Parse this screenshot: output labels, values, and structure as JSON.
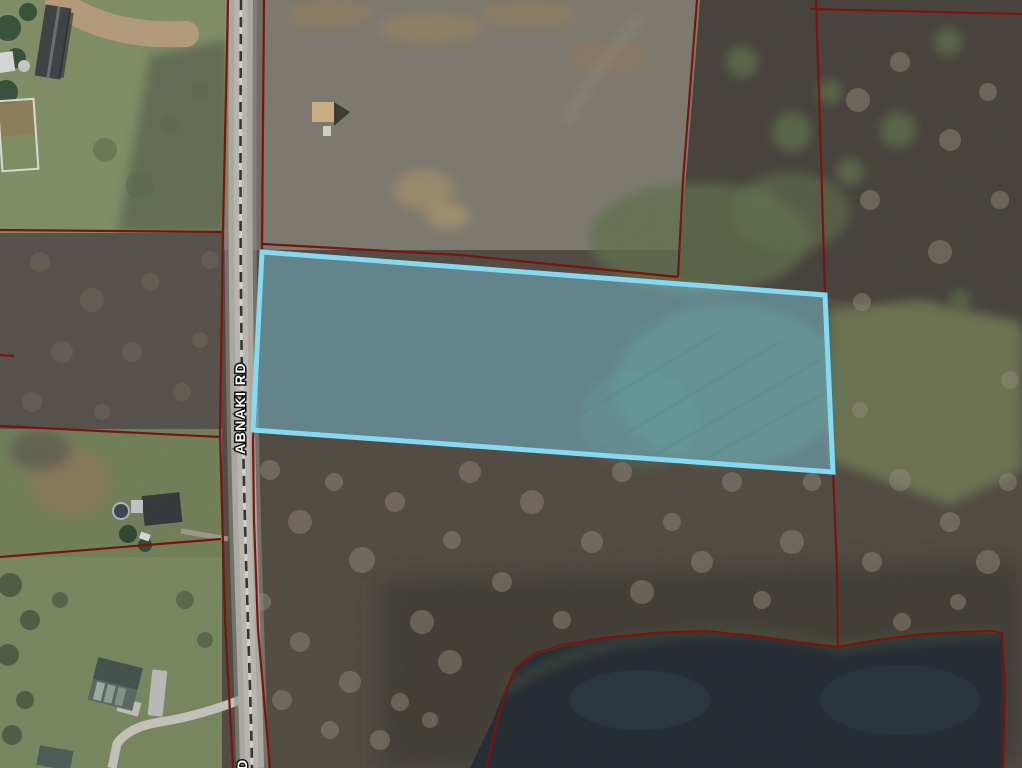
{
  "map": {
    "road_label": "ABNAKI RD",
    "road_label_partial_bottom": "D",
    "colors": {
      "highlight_stroke": "#85d9f2",
      "highlight_fill": "rgba(125,210,238,0.42)",
      "parcel_line": "#7a150e",
      "water": "#232b32",
      "road_pavement": "#a9a79f"
    }
  }
}
